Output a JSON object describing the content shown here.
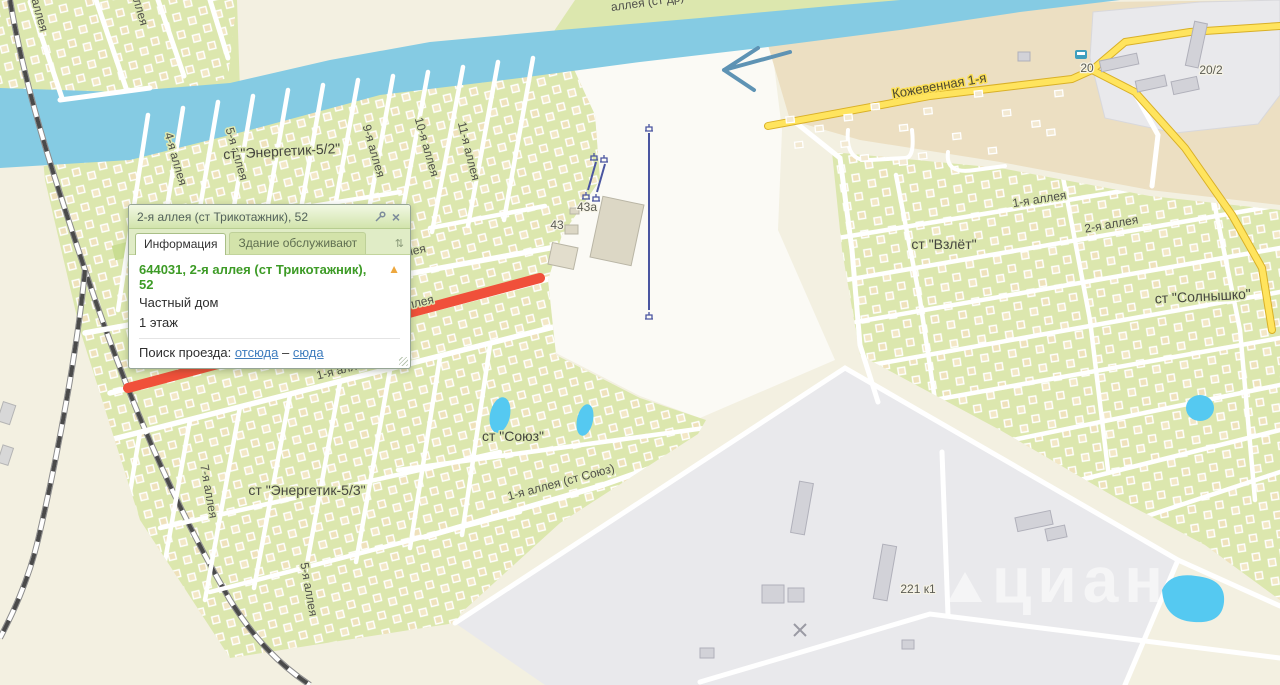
{
  "popup": {
    "title": "2-я аллея (ст Трикотажник), 52",
    "tabs": {
      "info": "Информация",
      "service": "Здание обслуживают"
    },
    "address": "644031, 2-я аллея (ст Трикотажник), 52",
    "building_type": "Частный дом",
    "floors": "1 этаж",
    "route_label": "Поиск проезда:",
    "route_from": "отсюда",
    "route_dash": "–",
    "route_to": "сюда",
    "icons": {
      "close": "×",
      "tabs_dropdown": "⇅",
      "warning": "▲"
    }
  },
  "map": {
    "watermark": "циан",
    "labels": [
      {
        "t": "аллея (ст др)",
        "x": 648,
        "y": 6,
        "r": -8,
        "c": "g"
      },
      {
        "t": "аллея",
        "x": 36,
        "y": 16,
        "r": 74,
        "c": "g"
      },
      {
        "t": "аллея",
        "x": 136,
        "y": 10,
        "r": 74,
        "c": "g"
      },
      {
        "t": "4-я аллея",
        "x": 172,
        "y": 160,
        "r": 74,
        "c": "g"
      },
      {
        "t": "5-я аллея",
        "x": 233,
        "y": 155,
        "r": 74,
        "c": "g"
      },
      {
        "t": "ст \"Энергетик-5/2\"",
        "x": 282,
        "y": 156,
        "r": -3,
        "c": "st g"
      },
      {
        "t": "9-я аллея",
        "x": 370,
        "y": 152,
        "r": 74,
        "c": "g"
      },
      {
        "t": "10-я аллея",
        "x": 423,
        "y": 148,
        "r": 74,
        "c": "g"
      },
      {
        "t": "11-я аллея",
        "x": 465,
        "y": 152,
        "r": 76,
        "c": "g"
      },
      {
        "t": "Кожевенная 1-я",
        "x": 940,
        "y": 90,
        "r": -10,
        "c": "yr"
      },
      {
        "t": "20",
        "x": 1087,
        "y": 72,
        "r": 0,
        "c": "hn"
      },
      {
        "t": "20/2",
        "x": 1211,
        "y": 74,
        "r": 0,
        "c": "hn"
      },
      {
        "t": "1-я аллея",
        "x": 1040,
        "y": 203,
        "r": -9,
        "c": "g"
      },
      {
        "t": "2-я аллея",
        "x": 1112,
        "y": 228,
        "r": -10,
        "c": "g"
      },
      {
        "t": "ст \"Взлёт\"",
        "x": 944,
        "y": 249,
        "r": 0,
        "c": "st g"
      },
      {
        "t": "ст \"Солнышко\"",
        "x": 1203,
        "y": 301,
        "r": -3,
        "c": "st g"
      },
      {
        "t": "43а",
        "x": 587,
        "y": 211,
        "r": 0,
        "c": "hn"
      },
      {
        "t": "43",
        "x": 557,
        "y": 229,
        "r": 0,
        "c": "hn"
      },
      {
        "t": "3-я аллея",
        "x": 400,
        "y": 258,
        "r": -13,
        "c": "g"
      },
      {
        "t": "2-я аллея",
        "x": 408,
        "y": 309,
        "r": -13,
        "c": "g"
      },
      {
        "t": "1-я аллея",
        "x": 344,
        "y": 373,
        "r": -14,
        "c": "g"
      },
      {
        "t": "ст \"Союз\"",
        "x": 513,
        "y": 441,
        "r": 0,
        "c": "st g"
      },
      {
        "t": "1-я аллея (ст Союз)",
        "x": 562,
        "y": 486,
        "r": -15,
        "c": "g"
      },
      {
        "t": "ст \"Энергетик-5/3\"",
        "x": 307,
        "y": 495,
        "r": 0,
        "c": "st g"
      },
      {
        "t": "7-я аллея",
        "x": 205,
        "y": 492,
        "r": 80,
        "c": "g"
      },
      {
        "t": "5-я аллея",
        "x": 305,
        "y": 590,
        "r": 80,
        "c": "g"
      },
      {
        "t": "221 к1",
        "x": 918,
        "y": 593,
        "r": 0,
        "c": "hn"
      }
    ]
  },
  "colors": {
    "highlight_red": "#f0503a",
    "river_blue": "#85cbe3",
    "road_yellow": "#ffe45e",
    "garden_green": "#dce7ae",
    "address_green": "#3d9b26",
    "link_blue": "#3f7dbe"
  }
}
